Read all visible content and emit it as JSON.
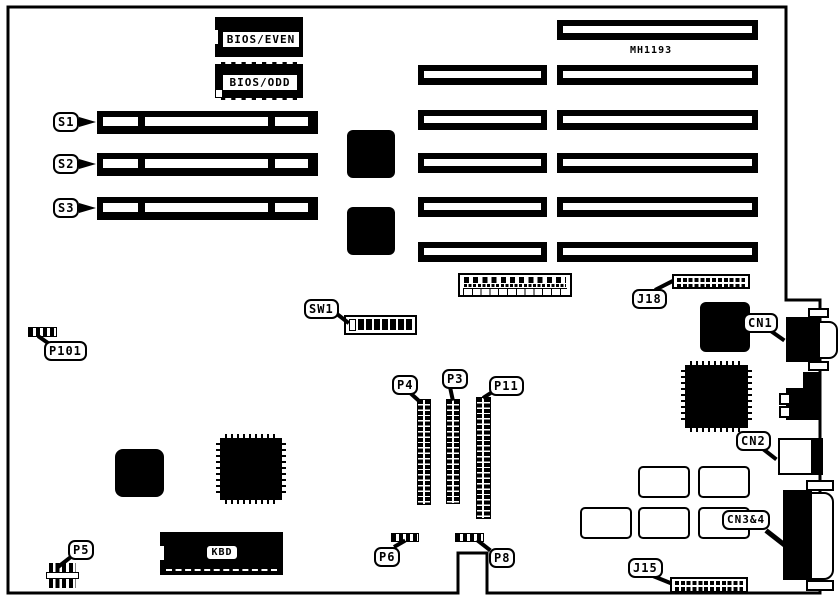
{
  "colors": {
    "ink": "#000000",
    "paper": "#ffffff"
  },
  "board": {
    "part_number": "MH1193",
    "chips": {
      "bios_even": "BIOS/EVEN",
      "bios_odd": "BIOS/ODD",
      "kbd": "KBD"
    },
    "callouts": {
      "s1": "S1",
      "s2": "S2",
      "s3": "S3",
      "sw1": "SW1",
      "p101": "P101",
      "p4": "P4",
      "p3": "P3",
      "p11": "P11",
      "p5": "P5",
      "p6": "P6",
      "p8": "P8",
      "j18": "J18",
      "j15": "J15",
      "cn1": "CN1",
      "cn2": "CN2",
      "cn34": "CN3&4"
    }
  }
}
